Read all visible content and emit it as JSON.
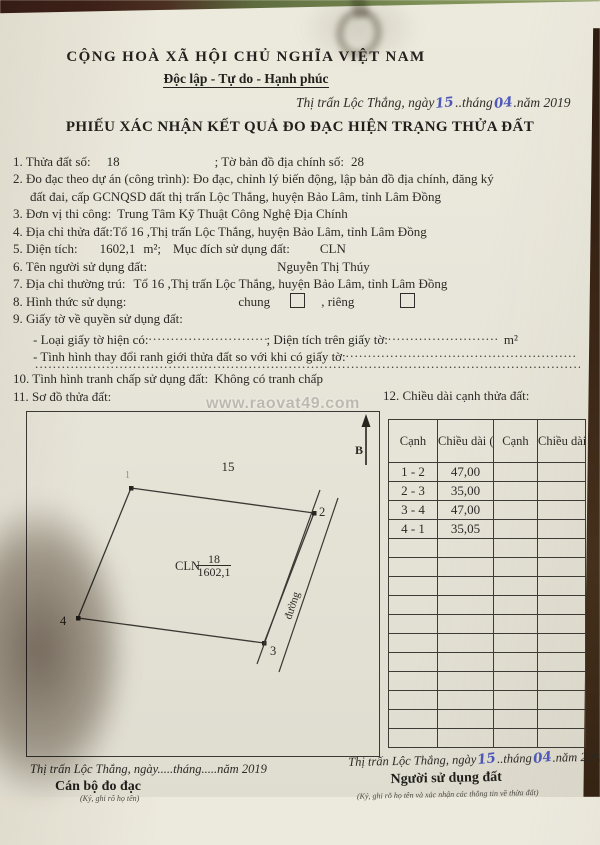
{
  "colors": {
    "paper": "#e8e6da",
    "ink": "#2b2a26",
    "handwriting_blue": "#4e58b8",
    "table_border": "#3c3b36",
    "background_wood": "#3a2516",
    "background_green": "#6f7f4a"
  },
  "header": {
    "national_title": "CỘNG HOÀ XÃ HỘI CHỦ NGHĨA VIỆT NAM",
    "motto": "Độc lập - Tự do - Hạnh phúc",
    "date": {
      "prefix": "Thị trấn Lộc Thắng, ngày",
      "day": "15",
      "between": "..tháng",
      "month": "04",
      "suffix": ".năm 2019"
    },
    "form_title": "PHIẾU XÁC NHẬN KẾT QUẢ ĐO ĐẠC HIỆN TRẠNG THỬA ĐẤT"
  },
  "items": {
    "i1": {
      "label": "1. Thửa đất số:",
      "value": "18",
      "label2": "; Tờ bản đồ địa chính số:",
      "value2": "28"
    },
    "i2_line1": "2. Đo đạc theo dự án (công trình): Đo đạc, chỉnh lý biến động, lập bản đồ địa chính, đăng ký",
    "i2_line2": "đất đai, cấp GCNQSD đất thị trấn Lộc Thắng, huyện Bảo Lâm, tỉnh Lâm Đồng",
    "i3": {
      "label": "3. Đơn vị thi công:",
      "value": "Trung Tâm Kỹ Thuật Công Nghệ Địa Chính"
    },
    "i4": {
      "label": "4. Địa chỉ thửa đất:",
      "value": "Tổ 16 ,Thị trấn Lộc Thắng, huyện Bảo Lâm, tỉnh Lâm Đồng"
    },
    "i5": {
      "label": "5. Diện tích:",
      "area": "1602,1",
      "unit": "m²;",
      "label2": "Mục đích sử dụng đất:",
      "value2": "CLN"
    },
    "i6": {
      "label": "6. Tên người sử dụng đất:",
      "value": "Nguyễn Thị Thúy"
    },
    "i7": {
      "label": "7. Địa chỉ thường trú:",
      "value": "Tổ 16 ,Thị trấn Lộc Thắng, huyện Bảo Lâm, tỉnh Lâm Đồng"
    },
    "i8": {
      "label": "8. Hình thức sử dụng:",
      "opt1": "chung",
      "opt2": ", riêng"
    },
    "i9": {
      "label": "9. Giấy tờ về quyền sử dụng đất:",
      "sub1_label": "- Loại giấy tờ hiện có:",
      "sub1_dots": "......................................................",
      "sub1_mid": "; Diện tích trên giấy tờ:",
      "sub1_dots2": "......................................................",
      "sub1_unit": "m²",
      "sub2_label": "- Tình hình thay đổi ranh giới thửa đất so với khi có giấy tờ:",
      "sub2_dots": "..........................................................................................................",
      "dots_line": "........................................................................................................................................................................................"
    },
    "i10": {
      "label": "10. Tình hình tranh chấp sử dụng đất:",
      "value": "Không có tranh chấp"
    },
    "i11": {
      "label": "11. Sơ đồ thửa đất:"
    },
    "i12": {
      "label": "12. Chiều dài cạnh thửa đất:"
    }
  },
  "watermark": "www.raovat49.com",
  "sketch": {
    "north_label": "B",
    "adjacent_parcel": "15",
    "road_label": "đường",
    "parcel": {
      "land_use": "CLN",
      "number": "18",
      "area": "1602,1"
    },
    "vertices": [
      "1",
      "2",
      "3",
      "4"
    ]
  },
  "table": {
    "headers": [
      "Cạnh",
      "Chiều dài (m)",
      "Cạnh",
      "Chiều dài (m)"
    ],
    "rows": [
      {
        "edge": "1 - 2",
        "length": "47,00"
      },
      {
        "edge": "2 - 3",
        "length": "35,00"
      },
      {
        "edge": "3 - 4",
        "length": "47,00"
      },
      {
        "edge": "4 - 1",
        "length": "35,05"
      }
    ],
    "empty_row_count": 11
  },
  "signatures": {
    "left": {
      "date_line": "Thị trấn Lộc Thắng, ngày.....tháng.....năm 2019",
      "role": "Cán bộ đo đạc",
      "note": "(Ký, ghi rõ họ tên)"
    },
    "right": {
      "date_prefix": "Thị trấn Lộc Thắng, ngày",
      "day": "15",
      "between": "..tháng",
      "month": "04",
      "suffix": ".năm 2019",
      "role": "Người sử dụng đất",
      "note": "(Ký, ghi rõ họ tên và xác nhận các thông tin về thửa đất)"
    }
  }
}
